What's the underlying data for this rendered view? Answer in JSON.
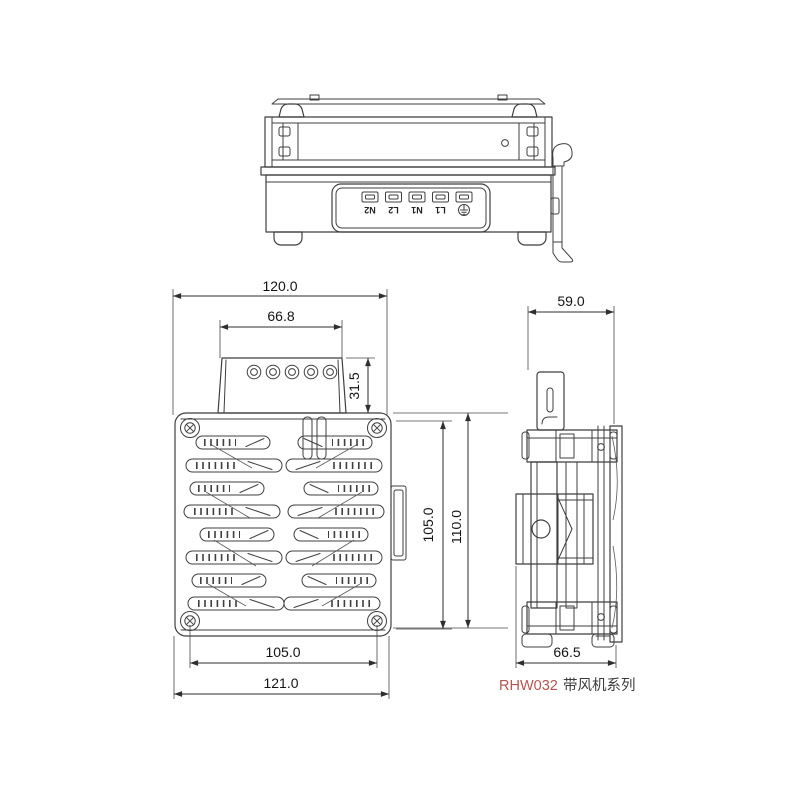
{
  "drawing": {
    "product_label": {
      "model": "RHW032",
      "series": "带风机系列"
    },
    "terminal_labels": [
      "N2",
      "L2",
      "N1",
      "L1"
    ],
    "dimensions": {
      "front": {
        "top_width": "120.0",
        "cover_width": "66.8",
        "cover_height": "31.5",
        "right_height": "105.0",
        "right_overall_height": "110.0",
        "bottom_hole_spacing": "105.0",
        "bottom_overall_width": "121.0"
      },
      "side": {
        "top_depth": "59.0",
        "bottom_depth": "66.5"
      }
    }
  },
  "colors": {
    "line": "#3f3f3f",
    "dimension_text": "#141414",
    "model_text": "#b65550",
    "series_text": "#3c3c3c"
  }
}
